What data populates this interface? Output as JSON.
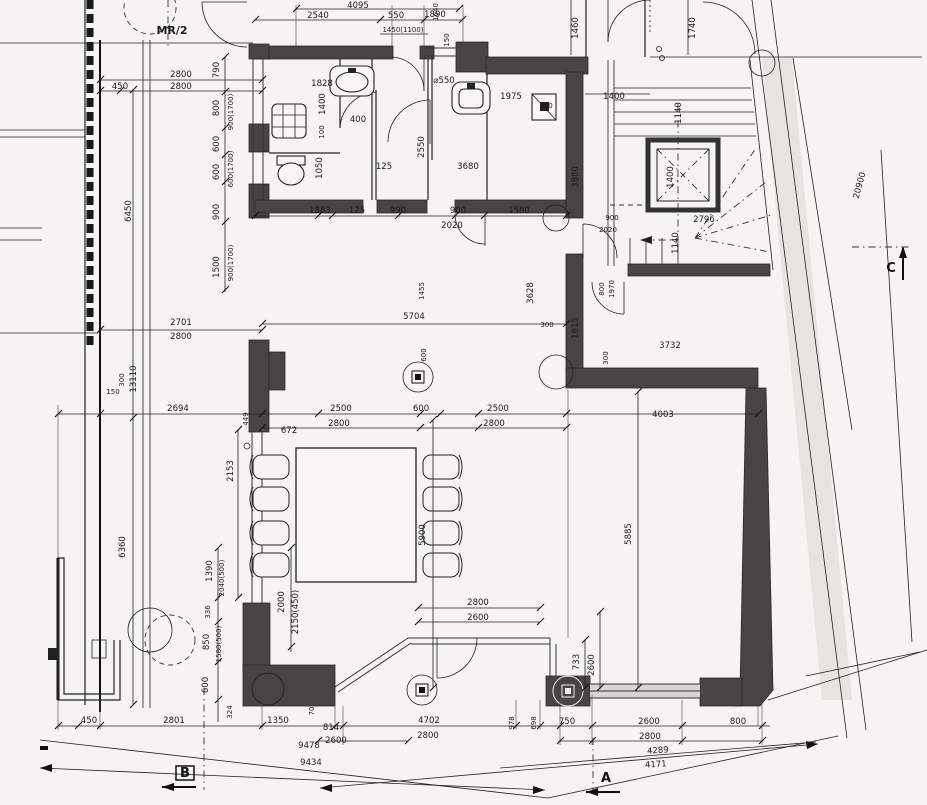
{
  "drawing": {
    "type": "architectural-floor-plan",
    "plan_label": "MR/2",
    "section_markers": {
      "a": "A",
      "b": "B",
      "c": "C"
    },
    "colors": {
      "paper": "#f5f4f0",
      "wall": "#474441",
      "line": "#1b1b1b"
    },
    "dimension_labels": [
      {
        "t": "4095",
        "x": 358,
        "y": 8
      },
      {
        "t": "2540",
        "x": 318,
        "y": 18
      },
      {
        "t": "550",
        "x": 396,
        "y": 18
      },
      {
        "t": "1890",
        "x": 435,
        "y": 17
      },
      {
        "t": "1450(1100)",
        "x": 403,
        "y": 32,
        "s": 1
      },
      {
        "t": "1640",
        "x": 438,
        "y": 12,
        "r": -90,
        "s": 1
      },
      {
        "t": "150",
        "x": 449,
        "y": 40,
        "r": -90,
        "s": 1
      },
      {
        "t": "1460",
        "x": 578,
        "y": 28,
        "r": -90
      },
      {
        "t": "1740",
        "x": 695,
        "y": 28,
        "r": -90
      },
      {
        "t": "2800",
        "x": 181,
        "y": 77
      },
      {
        "t": "450",
        "x": 120,
        "y": 89
      },
      {
        "t": "2800",
        "x": 181,
        "y": 89
      },
      {
        "t": "1400",
        "x": 614,
        "y": 99
      },
      {
        "t": "1140",
        "x": 681,
        "y": 113,
        "r": -90
      },
      {
        "t": "790",
        "x": 219,
        "y": 70,
        "r": -90
      },
      {
        "t": "800",
        "x": 219,
        "y": 108,
        "r": -90
      },
      {
        "t": "900(1700)",
        "x": 233,
        "y": 112,
        "r": -90,
        "s": 1
      },
      {
        "t": "600",
        "x": 219,
        "y": 144,
        "r": -90
      },
      {
        "t": "600",
        "x": 219,
        "y": 172,
        "r": -90
      },
      {
        "t": "600(1700)",
        "x": 233,
        "y": 169,
        "r": -90,
        "s": 1
      },
      {
        "t": "900",
        "x": 219,
        "y": 212,
        "r": -90
      },
      {
        "t": "1500",
        "x": 219,
        "y": 267,
        "r": -90
      },
      {
        "t": "900(1700)",
        "x": 233,
        "y": 263,
        "r": -90,
        "s": 1
      },
      {
        "t": "6450",
        "x": 131,
        "y": 211,
        "r": -90
      },
      {
        "t": "1828",
        "x": 322,
        "y": 86
      },
      {
        "t": "1400",
        "x": 325,
        "y": 104,
        "r": -90
      },
      {
        "t": "400",
        "x": 358,
        "y": 122
      },
      {
        "t": "100",
        "x": 324,
        "y": 132,
        "r": -90,
        "s": 1
      },
      {
        "t": "1050",
        "x": 322,
        "y": 168,
        "r": -90
      },
      {
        "t": "⌀550",
        "x": 444,
        "y": 83
      },
      {
        "t": "1975",
        "x": 511,
        "y": 99
      },
      {
        "t": "300",
        "x": 546,
        "y": 108,
        "s": 1
      },
      {
        "t": "2550",
        "x": 424,
        "y": 147,
        "r": -90
      },
      {
        "t": "125",
        "x": 384,
        "y": 169
      },
      {
        "t": "3680",
        "x": 468,
        "y": 169
      },
      {
        "t": "1883",
        "x": 320,
        "y": 213
      },
      {
        "t": "125",
        "x": 357,
        "y": 213
      },
      {
        "t": "990",
        "x": 398,
        "y": 213
      },
      {
        "t": "900",
        "x": 458,
        "y": 213
      },
      {
        "t": "2020",
        "x": 452,
        "y": 228
      },
      {
        "t": "1580",
        "x": 519,
        "y": 213
      },
      {
        "t": "3880",
        "x": 578,
        "y": 177,
        "r": -90
      },
      {
        "t": "900",
        "x": 612,
        "y": 220,
        "s": 1
      },
      {
        "t": "2020",
        "x": 608,
        "y": 232,
        "s": 1
      },
      {
        "t": "2796",
        "x": 704,
        "y": 222
      },
      {
        "t": "1400",
        "x": 673,
        "y": 177,
        "r": -90
      },
      {
        "t": "1140",
        "x": 678,
        "y": 243,
        "r": -90
      },
      {
        "t": "20900",
        "x": 862,
        "y": 186,
        "r": -75
      },
      {
        "t": "800",
        "x": 604,
        "y": 289,
        "r": -90,
        "s": 1
      },
      {
        "t": "1970",
        "x": 614,
        "y": 289,
        "r": -90,
        "s": 1
      },
      {
        "t": "1815",
        "x": 578,
        "y": 328,
        "r": -90
      },
      {
        "t": "300",
        "x": 608,
        "y": 358,
        "r": -90,
        "s": 1
      },
      {
        "t": "3732",
        "x": 670,
        "y": 348
      },
      {
        "t": "4003",
        "x": 663,
        "y": 417
      },
      {
        "t": "2701",
        "x": 181,
        "y": 325
      },
      {
        "t": "2800",
        "x": 181,
        "y": 339
      },
      {
        "t": "5704",
        "x": 414,
        "y": 319
      },
      {
        "t": "1455",
        "x": 424,
        "y": 291,
        "r": -90,
        "s": 1
      },
      {
        "t": "3628",
        "x": 533,
        "y": 293,
        "r": -90
      },
      {
        "t": "300",
        "x": 547,
        "y": 327,
        "s": 1
      },
      {
        "t": "300",
        "x": 124,
        "y": 380,
        "r": -90,
        "s": 1
      },
      {
        "t": "13110",
        "x": 136,
        "y": 379,
        "r": -90
      },
      {
        "t": "150",
        "x": 113,
        "y": 394,
        "s": 1
      },
      {
        "t": "2694",
        "x": 178,
        "y": 411
      },
      {
        "t": "449",
        "x": 248,
        "y": 419,
        "r": -90,
        "s": 1
      },
      {
        "t": "672",
        "x": 289,
        "y": 433
      },
      {
        "t": "2500",
        "x": 341,
        "y": 411
      },
      {
        "t": "2800",
        "x": 339,
        "y": 426
      },
      {
        "t": "600",
        "x": 421,
        "y": 411
      },
      {
        "t": "2500",
        "x": 498,
        "y": 411
      },
      {
        "t": "2800",
        "x": 494,
        "y": 426
      },
      {
        "t": "600",
        "x": 426,
        "y": 355,
        "r": -90,
        "s": 1
      },
      {
        "t": "2153",
        "x": 233,
        "y": 471,
        "r": -90
      },
      {
        "t": "5900",
        "x": 425,
        "y": 535,
        "r": -90
      },
      {
        "t": "5885",
        "x": 631,
        "y": 534,
        "r": -90
      },
      {
        "t": "6360",
        "x": 125,
        "y": 547,
        "r": -90
      },
      {
        "t": "1390",
        "x": 212,
        "y": 571,
        "r": -90
      },
      {
        "t": "2040(500)",
        "x": 224,
        "y": 578,
        "r": -90,
        "s": 1
      },
      {
        "t": "336",
        "x": 210,
        "y": 612,
        "r": -90,
        "s": 1
      },
      {
        "t": "850",
        "x": 209,
        "y": 642,
        "r": -90
      },
      {
        "t": "1580(500)",
        "x": 221,
        "y": 644,
        "r": -90,
        "s": 1
      },
      {
        "t": "600",
        "x": 208,
        "y": 685,
        "r": -90
      },
      {
        "t": "2000",
        "x": 284,
        "y": 602,
        "r": -90
      },
      {
        "t": "2150(450)",
        "x": 298,
        "y": 612,
        "r": -90
      },
      {
        "t": "324",
        "x": 232,
        "y": 712,
        "r": -90,
        "s": 1
      },
      {
        "t": "2800",
        "x": 478,
        "y": 605
      },
      {
        "t": "2600",
        "x": 478,
        "y": 620
      },
      {
        "t": "733",
        "x": 579,
        "y": 662,
        "r": -90
      },
      {
        "t": "2600",
        "x": 594,
        "y": 665,
        "r": -90
      },
      {
        "t": "450",
        "x": 89,
        "y": 723
      },
      {
        "t": "2801",
        "x": 174,
        "y": 723
      },
      {
        "t": "1350",
        "x": 278,
        "y": 723
      },
      {
        "t": "70",
        "x": 314,
        "y": 711,
        "r": -90,
        "s": 1
      },
      {
        "t": "814",
        "x": 331,
        "y": 730
      },
      {
        "t": "2600",
        "x": 336,
        "y": 743
      },
      {
        "t": "9478",
        "x": 309,
        "y": 748
      },
      {
        "t": "4702",
        "x": 429,
        "y": 723
      },
      {
        "t": "2800",
        "x": 428,
        "y": 738
      },
      {
        "t": "9434",
        "x": 311,
        "y": 765
      },
      {
        "t": "978",
        "x": 514,
        "y": 723,
        "r": -90,
        "s": 1
      },
      {
        "t": "698",
        "x": 536,
        "y": 723,
        "r": -90,
        "s": 1
      },
      {
        "t": "750",
        "x": 567,
        "y": 724
      },
      {
        "t": "2600",
        "x": 649,
        "y": 724
      },
      {
        "t": "800",
        "x": 738,
        "y": 724
      },
      {
        "t": "2800",
        "x": 650,
        "y": 739
      },
      {
        "t": "4289",
        "x": 658,
        "y": 753,
        "r": -4
      },
      {
        "t": "4171",
        "x": 656,
        "y": 767,
        "r": -4
      }
    ]
  }
}
